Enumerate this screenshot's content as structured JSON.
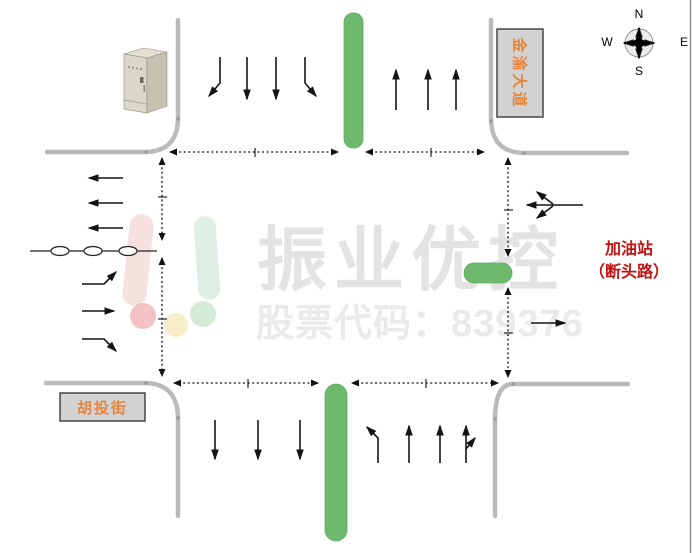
{
  "compass": {
    "north": "N",
    "south": "S",
    "east": "E",
    "west": "W"
  },
  "road_signs": {
    "north_road": "金渝大道",
    "west_road": "胡投街"
  },
  "east_annotation": {
    "line1": "加油站",
    "line2": "（断头路）"
  },
  "watermark": {
    "brand": "振业优控",
    "stock_code": "股票代码：839376"
  },
  "colors": {
    "median_green": "#6db96d",
    "road_gray": "#bababa",
    "sign_fill": "#d2d2d2",
    "sign_text": "#e8853a",
    "annotation_red": "#c41212",
    "watermark_gray": "#e3e3e3",
    "arrow_black": "#141414"
  },
  "lane_arrows": {
    "north_approach_southbound": [
      "bend-left",
      "straight",
      "straight",
      "bend-right"
    ],
    "north_exit_northbound": [
      "straight",
      "straight",
      "straight"
    ],
    "west_exit_westbound": [
      "straight",
      "straight",
      "straight"
    ],
    "west_approach_eastbound": [
      "bend-up",
      "straight",
      "bend-down"
    ],
    "south_exit_southbound": [
      "straight",
      "straight",
      "straight"
    ],
    "south_approach_northbound": [
      "turn-left",
      "straight",
      "straight",
      "straight-plus-right"
    ],
    "east_approach_westbound": [
      "left-straight-right-combined"
    ],
    "east_exit_eastbound": [
      "straight"
    ]
  },
  "detector_loops_count": 3
}
